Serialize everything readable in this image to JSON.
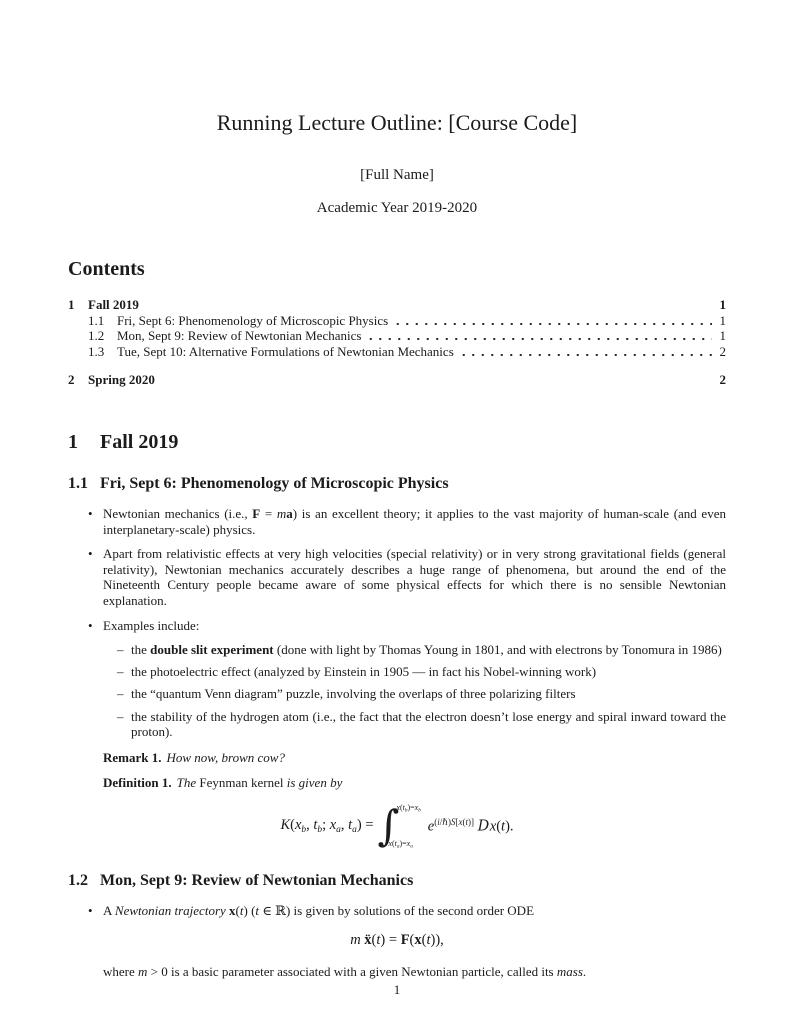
{
  "colors": {
    "text": "#1b1b1b",
    "background": "#ffffff"
  },
  "glyphs": {
    "bullet": "•",
    "dash": "–"
  },
  "document": {
    "title": "Running Lecture Outline: [Course Code]",
    "author": "[Full Name]",
    "date": "Academic Year 2019-2020",
    "page_number": "1"
  },
  "contents": {
    "heading": "Contents",
    "entries": [
      {
        "num": "1",
        "label": "Fall 2019",
        "page": "1"
      },
      {
        "num": "1.1",
        "label": "Fri, Sept 6: Phenomenology of Microscopic Physics",
        "page": "1"
      },
      {
        "num": "1.2",
        "label": "Mon, Sept 9: Review of Newtonian Mechanics",
        "page": "1"
      },
      {
        "num": "1.3",
        "label": "Tue, Sept 10: Alternative Formulations of Newtonian Mechanics",
        "page": "2"
      },
      {
        "num": "2",
        "label": "Spring 2020",
        "page": "2"
      }
    ]
  },
  "section1": {
    "num": "1",
    "title": "Fall 2019"
  },
  "sub11": {
    "num": "1.1",
    "title": "Fri, Sept 6: Phenomenology of Microscopic Physics",
    "bullet1": [
      {
        "t": "Newtonian mechanics (i.e., "
      },
      {
        "t": "F",
        "b": true
      },
      {
        "t": " = "
      },
      {
        "t": "m",
        "i": true
      },
      {
        "t": "a",
        "b": true
      },
      {
        "t": ") is an excellent theory; it applies to the vast majority of human-scale (and even interplanetary-scale) physics."
      }
    ],
    "bullet2": [
      {
        "t": "Apart from relativistic effects at very high velocities (special relativity) or in very strong gravitational fields (general relativity), Newtonian mechanics accurately describes a huge range of phenomena, but around the end of the Nineteenth Century people became aware of some physical effects for which there is no sensible Newtonian explanation."
      }
    ],
    "bullet3": [
      {
        "t": "Examples include:"
      }
    ],
    "examples": [
      [
        {
          "t": "the "
        },
        {
          "t": "double slit experiment",
          "b": true
        },
        {
          "t": " (done with light by Thomas Young in 1801, and with electrons by Tonomura in 1986)"
        }
      ],
      [
        {
          "t": "the photoelectric effect (analyzed by Einstein in 1905 — in fact his Nobel-winning work)"
        }
      ],
      [
        {
          "t": "the “quantum Venn diagram” puzzle, involving the overlaps of three polarizing filters"
        }
      ],
      [
        {
          "t": "the stability of the hydrogen atom (i.e., the fact that the electron doesn’t lose energy and spiral inward toward the proton)."
        }
      ]
    ],
    "remark_label": "Remark 1.",
    "remark_body": [
      {
        "t": "How now, brown cow?",
        "i": true
      }
    ],
    "definition_label": "Definition 1.",
    "definition_body": [
      {
        "t": "The ",
        "i": true
      },
      {
        "t": "Feynman kernel"
      },
      {
        "t": " is given by",
        "i": true
      }
    ],
    "formula": {
      "lhs": [
        {
          "t": "K",
          "i": true
        },
        {
          "t": "("
        },
        {
          "t": "x",
          "i": true
        },
        {
          "t": "b",
          "i": true,
          "sub": true
        },
        {
          "t": ", "
        },
        {
          "t": "t",
          "i": true
        },
        {
          "t": "b",
          "i": true,
          "sub": true
        },
        {
          "t": "; "
        },
        {
          "t": "x",
          "i": true
        },
        {
          "t": "a",
          "i": true,
          "sub": true
        },
        {
          "t": ", "
        },
        {
          "t": "t",
          "i": true
        },
        {
          "t": "a",
          "i": true,
          "sub": true
        },
        {
          "t": ") = "
        }
      ],
      "sign": "∫",
      "upper": [
        {
          "t": "x",
          "i": true
        },
        {
          "t": "("
        },
        {
          "t": "t",
          "i": true
        },
        {
          "t": "b",
          "i": true,
          "sub": true
        },
        {
          "t": ")="
        },
        {
          "t": "x",
          "i": true
        },
        {
          "t": "b",
          "i": true,
          "sub": true
        }
      ],
      "lower": [
        {
          "t": "x",
          "i": true
        },
        {
          "t": "("
        },
        {
          "t": "t",
          "i": true
        },
        {
          "t": "a",
          "i": true,
          "sub": true
        },
        {
          "t": ")="
        },
        {
          "t": "x",
          "i": true
        },
        {
          "t": "a",
          "i": true,
          "sub": true
        }
      ],
      "rhs": [
        {
          "t": "e",
          "i": true
        },
        {
          "t": "(",
          "sup": true
        },
        {
          "t": "i",
          "i": true,
          "sup": true
        },
        {
          "t": "/ℏ)",
          "sup": true
        },
        {
          "t": "S",
          "i": true,
          "sup": true
        },
        {
          "t": "[",
          "sup": true
        },
        {
          "t": "x",
          "i": true,
          "sup": true
        },
        {
          "t": "(",
          "sup": true
        },
        {
          "t": "t",
          "i": true,
          "sup": true
        },
        {
          "t": ")]",
          "sup": true
        },
        {
          "t": " "
        },
        {
          "t": "D",
          "c": "script"
        },
        {
          "t": "x",
          "i": true
        },
        {
          "t": "("
        },
        {
          "t": "t",
          "i": true
        },
        {
          "t": ")."
        }
      ]
    }
  },
  "sub12": {
    "num": "1.2",
    "title": "Mon, Sept 9: Review of Newtonian Mechanics",
    "bullet1": [
      {
        "t": "A "
      },
      {
        "t": "Newtonian trajectory",
        "i": true
      },
      {
        "t": " "
      },
      {
        "t": "x",
        "b": true
      },
      {
        "t": "("
      },
      {
        "t": "t",
        "i": true
      },
      {
        "t": ") ("
      },
      {
        "t": "t",
        "i": true
      },
      {
        "t": " ∈ ℝ) is given by solutions of the second order ODE"
      }
    ],
    "formula": [
      {
        "t": "m",
        "i": true
      },
      {
        "t": " "
      },
      {
        "t": "ẍ",
        "b": true
      },
      {
        "t": "("
      },
      {
        "t": "t",
        "i": true
      },
      {
        "t": ") = "
      },
      {
        "t": "F",
        "b": true
      },
      {
        "t": "("
      },
      {
        "t": "x",
        "b": true
      },
      {
        "t": "("
      },
      {
        "t": "t",
        "i": true
      },
      {
        "t": ")),"
      }
    ],
    "continuation": [
      {
        "t": "where "
      },
      {
        "t": "m",
        "i": true
      },
      {
        "t": " > 0 is a basic parameter associated with a given Newtonian particle, called its "
      },
      {
        "t": "mass",
        "i": true
      },
      {
        "t": "."
      }
    ]
  }
}
